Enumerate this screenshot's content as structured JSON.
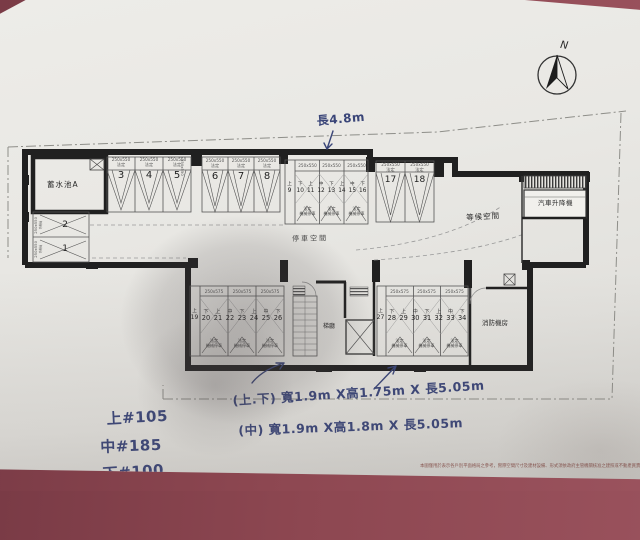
{
  "photo": {
    "paper_color": "#e9e8e4",
    "table_color": "#8d4751",
    "ink_color": "#3a4578"
  },
  "compass": {
    "label": "N"
  },
  "plan": {
    "rooms": {
      "water_tank": "蓄水池A",
      "aisle": "停車空間",
      "waiting": "等候空間",
      "car_lift": "汽車升降機",
      "elev_hall": "梯廳",
      "fire_room": "消防機房"
    },
    "stall_labels": {
      "legal": "法定",
      "mech": "機械停車"
    },
    "edge_stall_size": "250x550",
    "upper_left_stalls": [
      {
        "size": "250x550",
        "sub": "法定",
        "num": "2"
      },
      {
        "size": "250x550",
        "sub": "法定",
        "num": "1"
      }
    ],
    "bay345": [
      {
        "size": "250x550",
        "sub": "法定",
        "num": "3"
      },
      {
        "size": "250x550",
        "sub": "法定",
        "num": "4"
      },
      {
        "size": "250x550",
        "sub": "法定",
        "num": "5"
      }
    ],
    "bay678": [
      {
        "size": "250x550",
        "sub": "法定",
        "num": "6"
      },
      {
        "size": "250x550",
        "sub": "法定",
        "num": "7"
      },
      {
        "size": "250x550",
        "sub": "法定",
        "num": "8"
      }
    ],
    "bay1718": [
      {
        "size": "250x550",
        "sub": "法定",
        "num": "17"
      },
      {
        "size": "250x550",
        "sub": "法定",
        "num": "18"
      }
    ],
    "mid_stack": {
      "size": "250x550",
      "side": {
        "lv": "上",
        "num": "9"
      },
      "cols": [
        {
          "lv": "下",
          "num": "10"
        },
        {
          "lv": "上",
          "num": "11"
        },
        {
          "lv": "中",
          "num": "12"
        },
        {
          "lv": "下",
          "num": "13"
        },
        {
          "lv": "上",
          "num": "14"
        },
        {
          "lv": "中",
          "num": "15"
        },
        {
          "lv": "下",
          "num": "16"
        }
      ]
    },
    "lower_left_stack": {
      "size": "250x575",
      "side": {
        "lv": "上",
        "num": "19"
      },
      "cols": [
        {
          "lv": "下",
          "num": "20"
        },
        {
          "lv": "上",
          "num": "21"
        },
        {
          "lv": "中",
          "num": "22"
        },
        {
          "lv": "下",
          "num": "23"
        },
        {
          "lv": "上",
          "num": "24"
        },
        {
          "lv": "中",
          "num": "25"
        },
        {
          "lv": "下",
          "num": "26"
        }
      ]
    },
    "lower_right_stack": {
      "size": "250x575",
      "side": {
        "lv": "上",
        "num": "27"
      },
      "cols": [
        {
          "lv": "下",
          "num": "28"
        },
        {
          "lv": "上",
          "num": "29"
        },
        {
          "lv": "中",
          "num": "30"
        },
        {
          "lv": "下",
          "num": "31"
        },
        {
          "lv": "上",
          "num": "32"
        },
        {
          "lv": "中",
          "num": "33"
        },
        {
          "lv": "下",
          "num": "34"
        }
      ]
    }
  },
  "handwriting": {
    "top_dim": "長4.8m",
    "price_upper": "上#105",
    "price_middle": "中#185",
    "price_lower": "下#100",
    "dim_upper_lower": "(上.下) 寬1.9m X高1.75m X 長5.05m",
    "dim_middle": "(中)  寬1.9m X高1.8m X 長5.05m"
  },
  "disclaimer": "本圖僅用於表示各戶別平面格局之參考，實際空間尺寸及建材設備、形式須依政府主管機關核准之建照或不動產買賣契約書所記載為準"
}
